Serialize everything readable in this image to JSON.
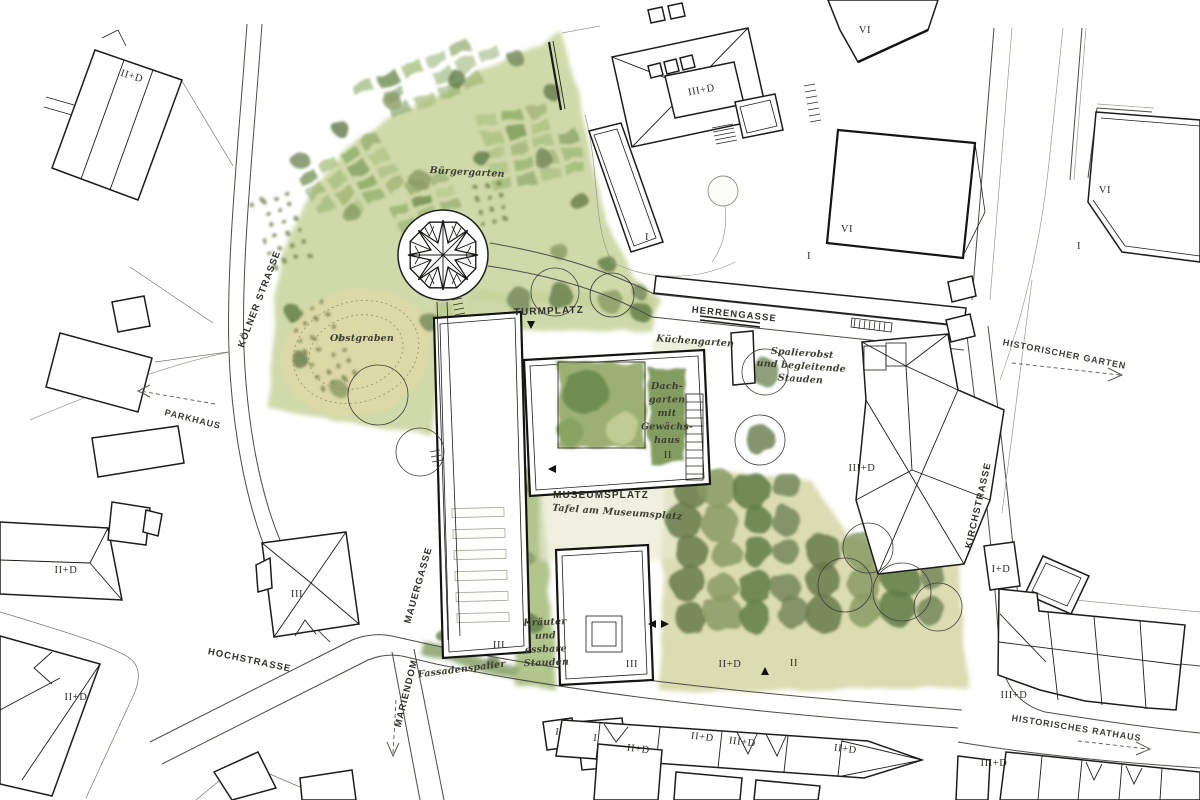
{
  "document": {
    "kind": "architectural site plan",
    "palette": {
      "paper": "#ffffff",
      "ink": "#1c1c1a",
      "road": "#4c4c46",
      "garden_wash": "#ccd6a2",
      "meadow": "#ddd9a6",
      "tree_dark": "#5e7b46",
      "tree_mid": "#74875a",
      "courtyard": "#9cb073"
    }
  },
  "map": {
    "labels": {
      "street_labels": [
        {
          "name": "koelner-strasse",
          "t": "KÖLNER STRASSE",
          "x": 262,
          "y": 300,
          "r": -69
        },
        {
          "name": "herrengasse",
          "t": "HERRENGASSE",
          "x": 734,
          "y": 317,
          "r": 6
        },
        {
          "name": "kirchstrasse",
          "t": "KIRCHSTRASSE",
          "x": 981,
          "y": 506,
          "r": -77
        },
        {
          "name": "hochstrasse",
          "t": "HOCHSTRASSE",
          "x": 249,
          "y": 663,
          "r": 12
        },
        {
          "name": "mauergasse",
          "t": "MAUERGASSE",
          "x": 421,
          "y": 586,
          "r": -74
        },
        {
          "name": "mariendom",
          "t": "MARIENDOM",
          "x": 409,
          "y": 694,
          "r": -76
        }
      ],
      "place_labels": [
        {
          "name": "turmplatz",
          "t": "TURMPLATZ",
          "x": 549,
          "y": 314,
          "r": -2
        },
        {
          "name": "museumsplatz",
          "t": "MUSEUMSPLATZ",
          "x": 601,
          "y": 498,
          "r": 0
        }
      ],
      "pointer_labels": [
        {
          "name": "parkhaus",
          "t": "PARKHAUS",
          "x": 192,
          "y": 422,
          "r": 14
        },
        {
          "name": "historischer-garten",
          "t": "HISTORISCHER GARTEN",
          "x": 1064,
          "y": 357,
          "r": 11
        },
        {
          "name": "historisches-rathaus",
          "t": "HISTORISCHES RATHAUS",
          "x": 1076,
          "y": 731,
          "r": 9
        }
      ],
      "garden_labels": [
        {
          "name": "buergergarten",
          "t": "Bürgergarten",
          "x": 467,
          "y": 175,
          "r": 3
        },
        {
          "name": "obstgraben",
          "t": "Obstgraben",
          "x": 362,
          "y": 341,
          "r": 0
        },
        {
          "name": "kuechengarten",
          "t": "Küchengarten",
          "x": 695,
          "y": 344,
          "r": 4
        },
        {
          "name": "spalierobst",
          "lines": [
            "Spalierobst",
            "und begleitende",
            "Stauden"
          ],
          "x": 802,
          "y": 356,
          "lh": 13,
          "r": 4
        },
        {
          "name": "dachgarten",
          "lines": [
            "Dach-",
            "garten",
            "mit",
            "Gewächs-",
            "haus"
          ],
          "x": 667,
          "y": 389,
          "lh": 13.5,
          "r": 0
        },
        {
          "name": "kraeuter",
          "lines": [
            "Kräuter",
            "und",
            "essbare",
            "Stauden"
          ],
          "x": 545,
          "y": 625,
          "lh": 13.5,
          "r": -2
        },
        {
          "name": "tafel-am-museumsplatz",
          "t": "Tafel am Museumsplatz",
          "x": 617,
          "y": 515,
          "r": 4
        },
        {
          "name": "fassadenspalier",
          "t": "Fassadenspalier",
          "x": 462,
          "y": 672,
          "r": -7
        }
      ],
      "building_labels": [
        {
          "t": "II+D",
          "x": 131,
          "y": 79,
          "r": 17
        },
        {
          "t": "II+D",
          "x": 66,
          "y": 573
        },
        {
          "t": "III",
          "x": 297,
          "y": 597
        },
        {
          "t": "II+D",
          "x": 76,
          "y": 700
        },
        {
          "t": "III",
          "x": 499,
          "y": 648
        },
        {
          "t": "III",
          "x": 632,
          "y": 667
        },
        {
          "t": "II",
          "x": 794,
          "y": 666
        },
        {
          "t": "II+D",
          "x": 730,
          "y": 667
        },
        {
          "t": "II",
          "x": 668,
          "y": 458
        },
        {
          "t": "III+D",
          "x": 702,
          "y": 93,
          "r": -11
        },
        {
          "t": "I",
          "x": 647,
          "y": 240
        },
        {
          "t": "VI",
          "x": 847,
          "y": 232
        },
        {
          "t": "I",
          "x": 809,
          "y": 259
        },
        {
          "t": "VI",
          "x": 865,
          "y": 33
        },
        {
          "t": "VI",
          "x": 1105,
          "y": 193
        },
        {
          "t": "I",
          "x": 1079,
          "y": 249
        },
        {
          "t": "III+D",
          "x": 862,
          "y": 471
        },
        {
          "t": "I+D",
          "x": 1001,
          "y": 572
        },
        {
          "t": "III+D",
          "x": 1014,
          "y": 698
        },
        {
          "t": "III+D",
          "x": 994,
          "y": 766
        },
        {
          "t": "I",
          "x": 557,
          "y": 735,
          "r": 6
        },
        {
          "t": "I",
          "x": 595,
          "y": 741,
          "r": 6
        },
        {
          "t": "II+D",
          "x": 638,
          "y": 752,
          "r": 7
        },
        {
          "t": "II+D",
          "x": 702,
          "y": 740,
          "r": 7
        },
        {
          "t": "III+D",
          "x": 742,
          "y": 745,
          "r": 7
        },
        {
          "t": "II+D",
          "x": 845,
          "y": 752,
          "r": 7
        }
      ]
    }
  }
}
